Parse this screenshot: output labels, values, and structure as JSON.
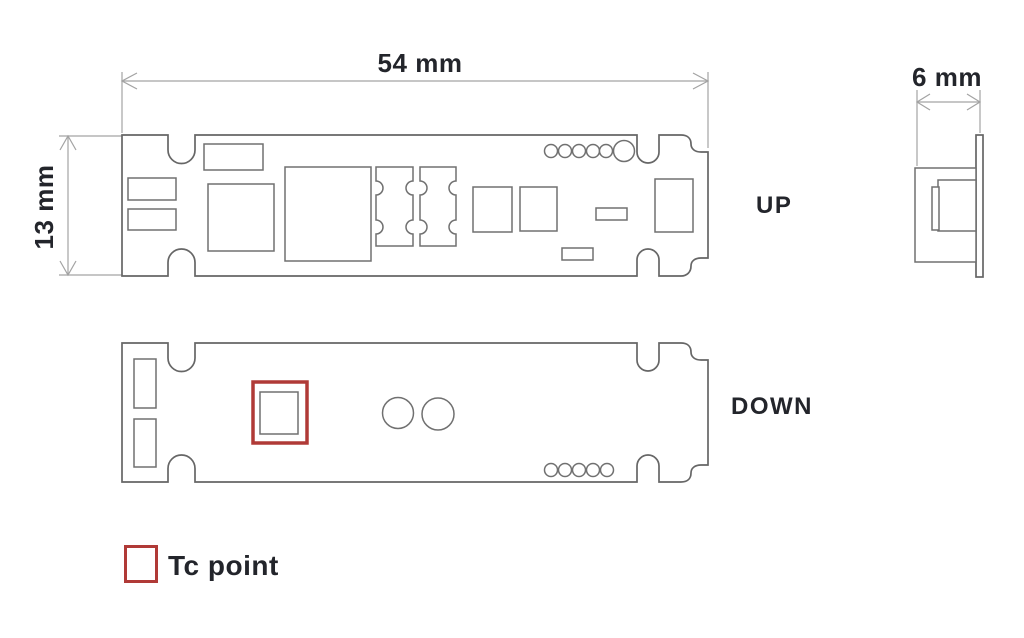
{
  "dimensions": {
    "width_label": "54 mm",
    "height_label": "13 mm",
    "side_label": "6 mm"
  },
  "views": {
    "up_label": "UP",
    "down_label": "DOWN"
  },
  "legend": {
    "tc_point_label": "Tc point"
  },
  "colors": {
    "background": "#ffffff",
    "text": "#23252b",
    "board_outline": "#666666",
    "component_outline": "#707070",
    "dimension_line": "#a3a3a3",
    "tc_accent": "#b03a37"
  }
}
